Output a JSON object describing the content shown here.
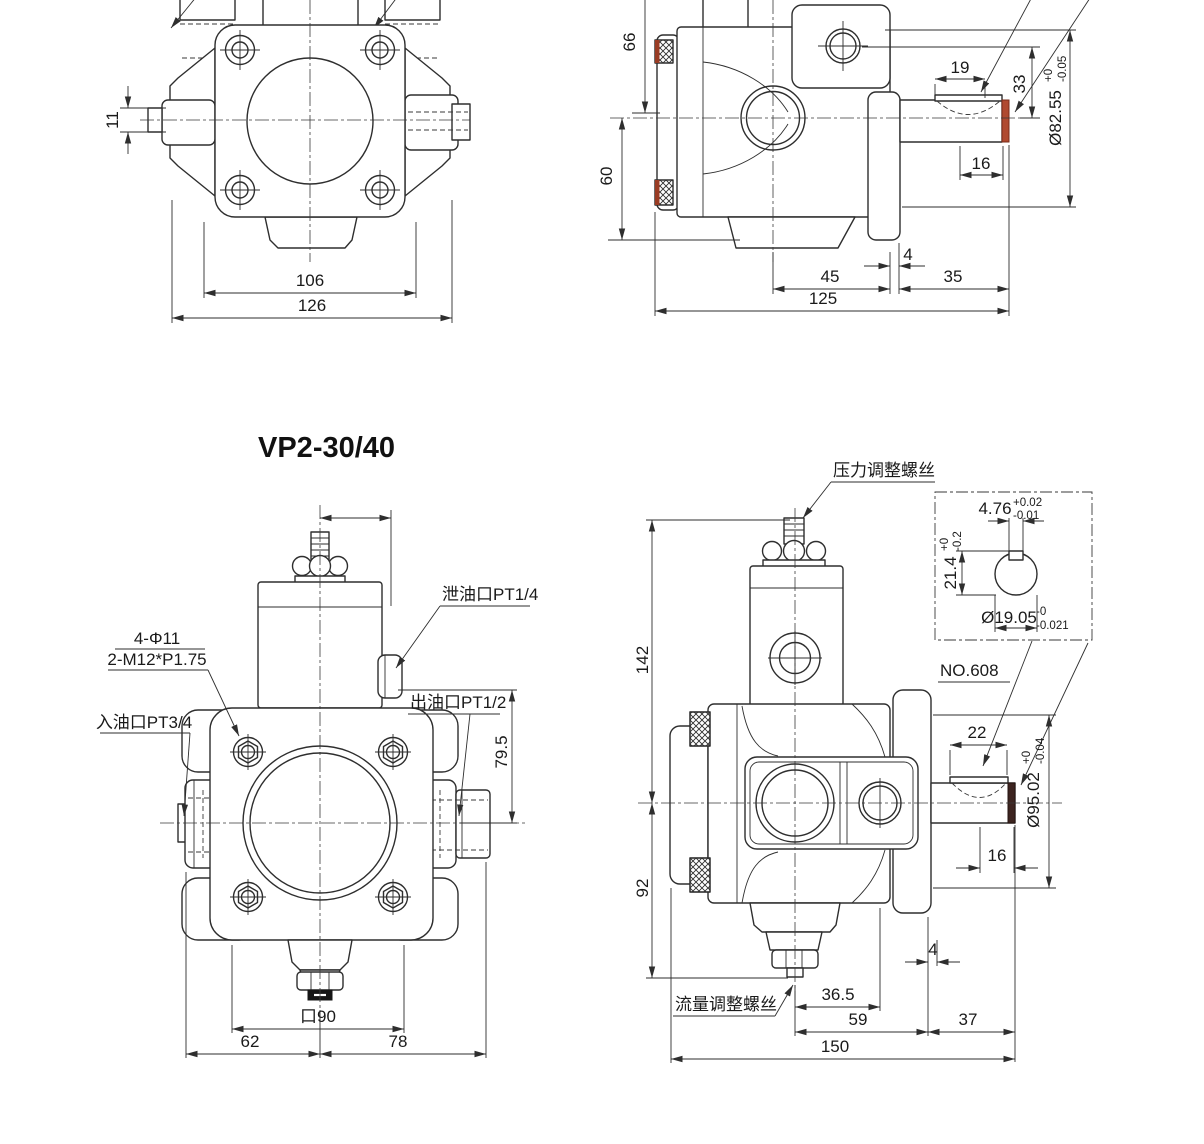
{
  "title": "VP2-30/40",
  "top_front": {
    "dims": {
      "stub": "11",
      "bolts": "106",
      "overall": "126"
    }
  },
  "top_side": {
    "dims": {
      "h66": "66",
      "h60": "60",
      "key_len": "19",
      "port_h": "33",
      "d16": "16",
      "d4": "4",
      "d45": "45",
      "d35": "35",
      "overall": "125"
    },
    "pilot_dia": {
      "value": "Ø82.55",
      "tol_top": "+0",
      "tol_bot": "-0.05"
    }
  },
  "bottom_front": {
    "labels": {
      "holes": "4-Φ11",
      "threads": "2-M12*P1.75",
      "inlet": "入油口PT3/4",
      "drain": "泄油口PT1/4",
      "outlet": "出油口PT1/2"
    },
    "dims": {
      "port_h": "79.5",
      "square": "口90",
      "left": "62",
      "right": "78"
    }
  },
  "bottom_side": {
    "labels": {
      "pressure_screw": "压力调整螺丝",
      "flow_screw": "流量调整螺丝",
      "bearing": "NO.608"
    },
    "dims": {
      "h142": "142",
      "h92": "92",
      "key_len": "22",
      "d16": "16",
      "d4": "4",
      "d36_5": "36.5",
      "d59": "59",
      "d37": "37",
      "overall": "150"
    },
    "pilot_dia": {
      "value": "Ø95.02",
      "tol_top": "+0",
      "tol_bot": "-0.04"
    },
    "detail": {
      "key_w": {
        "value": "4.76",
        "tol_top": "+0.02",
        "tol_bot": "-0.01"
      },
      "key_h": {
        "value": "21.4",
        "tol_top": "+0",
        "tol_bot": "-0.2"
      },
      "shaft_d": {
        "value": "Ø19.05",
        "tol_top": "-0",
        "tol_bot": "-0.021"
      }
    }
  }
}
